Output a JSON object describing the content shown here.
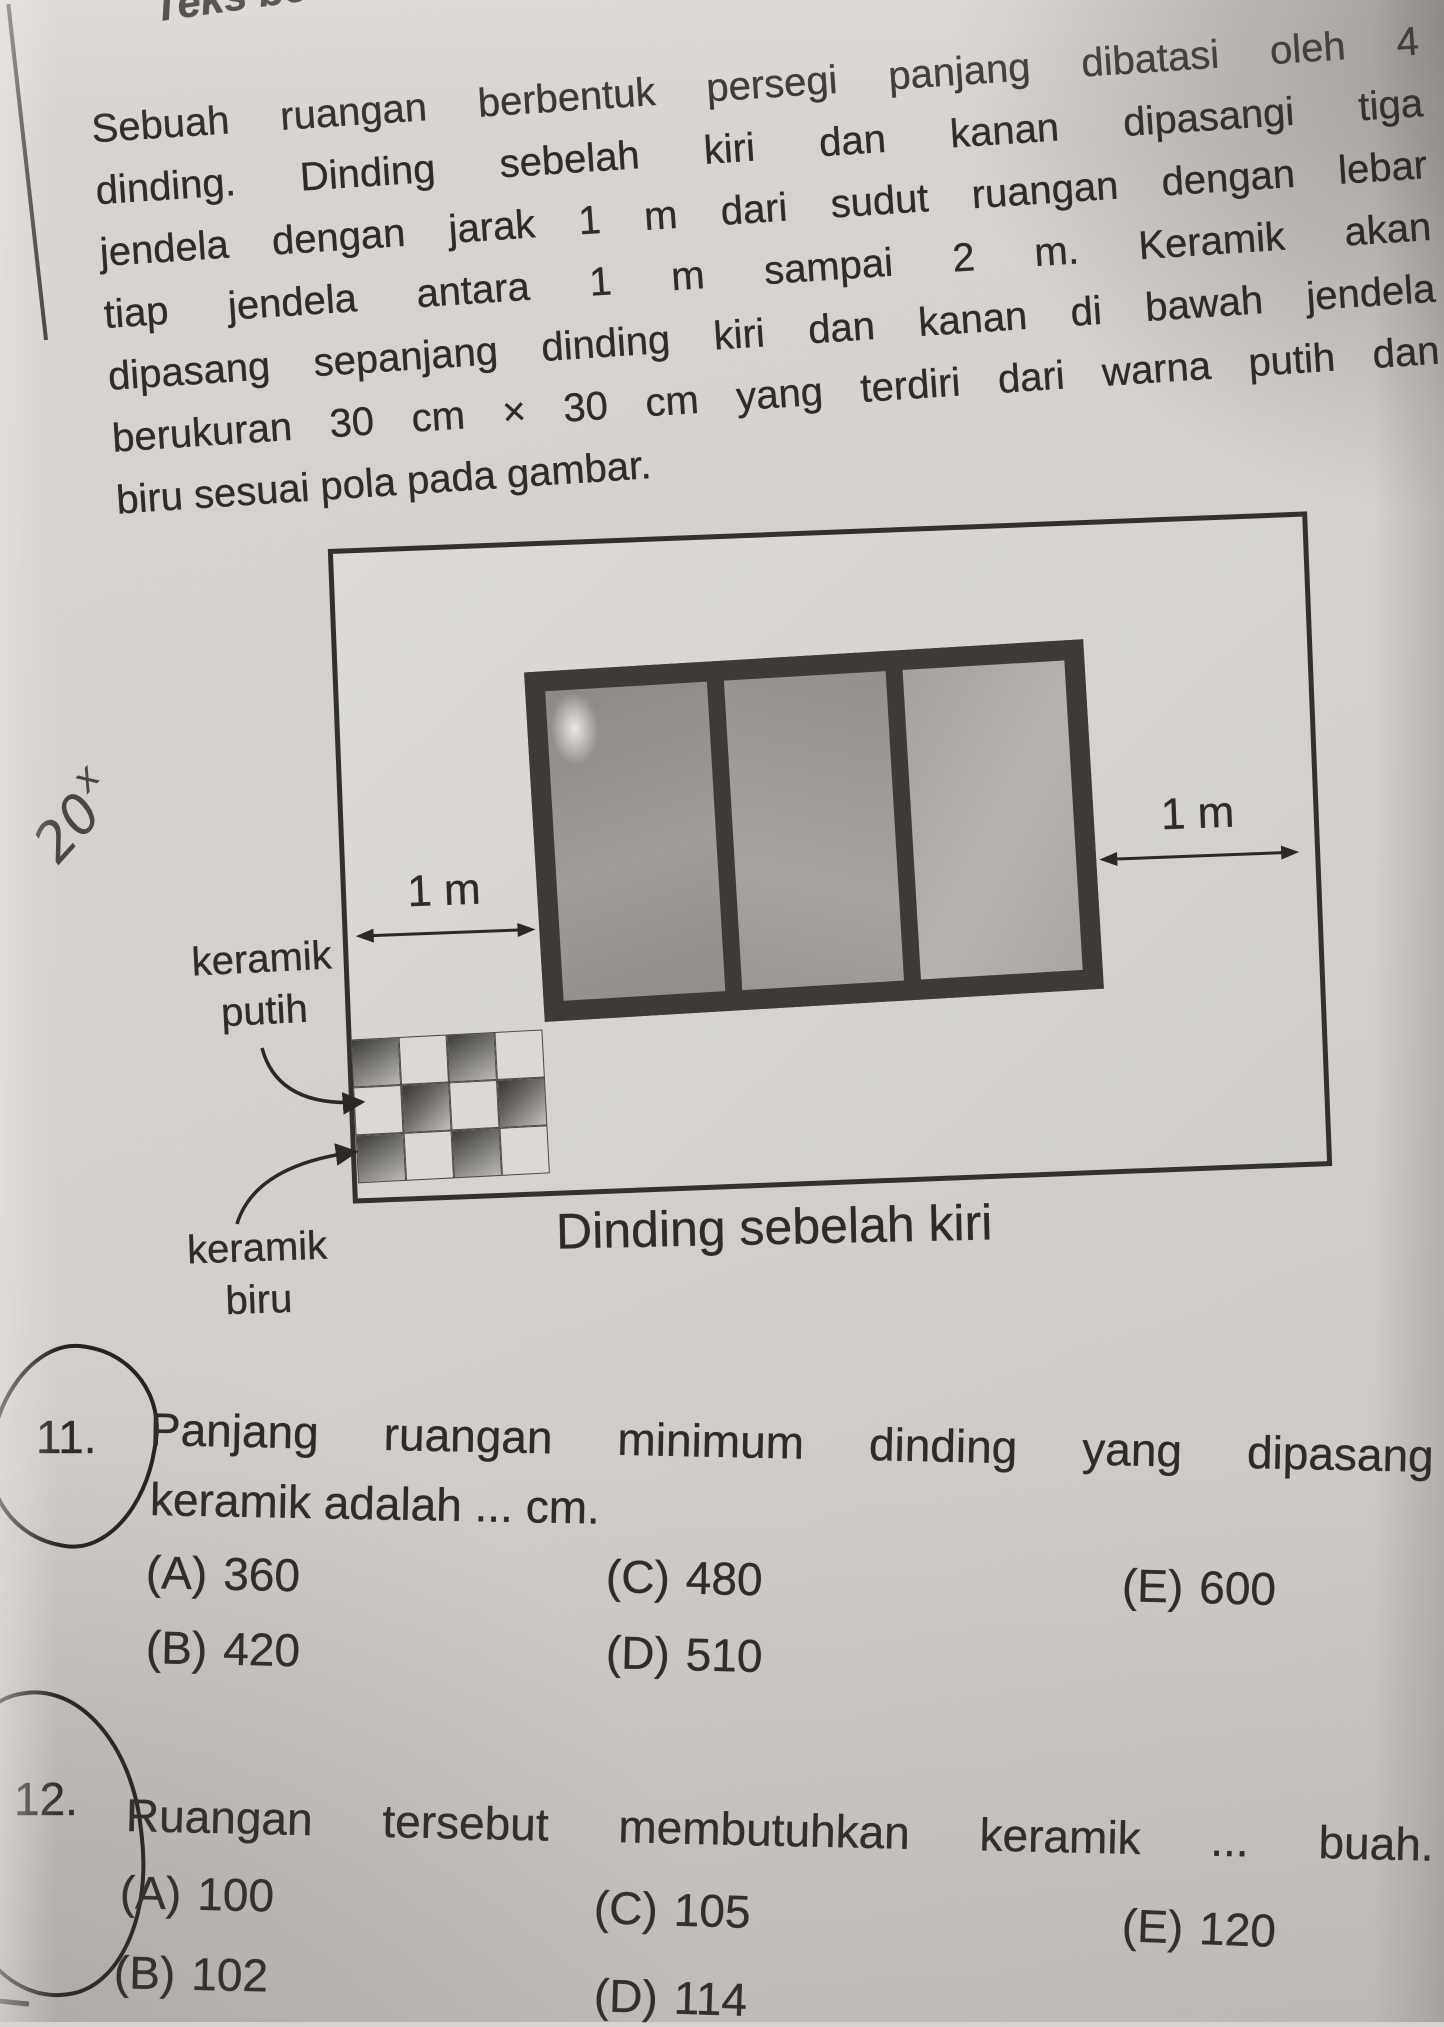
{
  "header": {
    "fragment": "Teks berikut"
  },
  "paragraph": {
    "lines": [
      "Sebuah ruangan berbentuk persegi panjang dibatasi oleh 4",
      "dinding. Dinding sebelah kiri dan kanan dipasangi tiga",
      "jendela dengan jarak 1 m dari sudut ruangan dengan lebar",
      "tiap jendela antara 1 m sampai 2 m. Keramik akan",
      "dipasang sepanjang dinding kiri dan kanan di bawah jendela",
      "berukuran 30 cm × 30 cm yang terdiri dari warna putih dan",
      "biru sesuai pola pada gambar."
    ]
  },
  "note": {
    "base": "20",
    "sup": "x"
  },
  "diagram": {
    "dim_left": "1 m",
    "dim_right": "1 m",
    "white_label": [
      "keramik",
      "putih"
    ],
    "blue_label": [
      "keramik",
      "biru"
    ],
    "caption": "Dinding sebelah kiri",
    "tile_pattern": [
      [
        "dark",
        "white",
        "dark",
        "white"
      ],
      [
        "white",
        "dark",
        "white",
        "dark"
      ],
      [
        "dark",
        "white",
        "dark",
        "white"
      ]
    ],
    "colors": {
      "paper": "#d4d1cc",
      "ink": "#2e2c28",
      "window_frame": "#3e3b36"
    }
  },
  "questions": [
    {
      "number": "11.",
      "line1": "Panjang ruangan minimum dinding yang dipasang",
      "line2": "keramik adalah ... cm.",
      "options": [
        {
          "key": "(A)",
          "value": "360"
        },
        {
          "key": "(B)",
          "value": "420"
        },
        {
          "key": "(C)",
          "value": "480"
        },
        {
          "key": "(D)",
          "value": "510"
        },
        {
          "key": "(E)",
          "value": "600"
        }
      ]
    },
    {
      "number": "12.",
      "line1": "Ruangan tersebut membutuhkan keramik ... buah.",
      "options": [
        {
          "key": "(A)",
          "value": "100"
        },
        {
          "key": "(B)",
          "value": "102"
        },
        {
          "key": "(C)",
          "value": "105"
        },
        {
          "key": "(D)",
          "value": "114"
        },
        {
          "key": "(E)",
          "value": "120"
        }
      ]
    }
  ]
}
